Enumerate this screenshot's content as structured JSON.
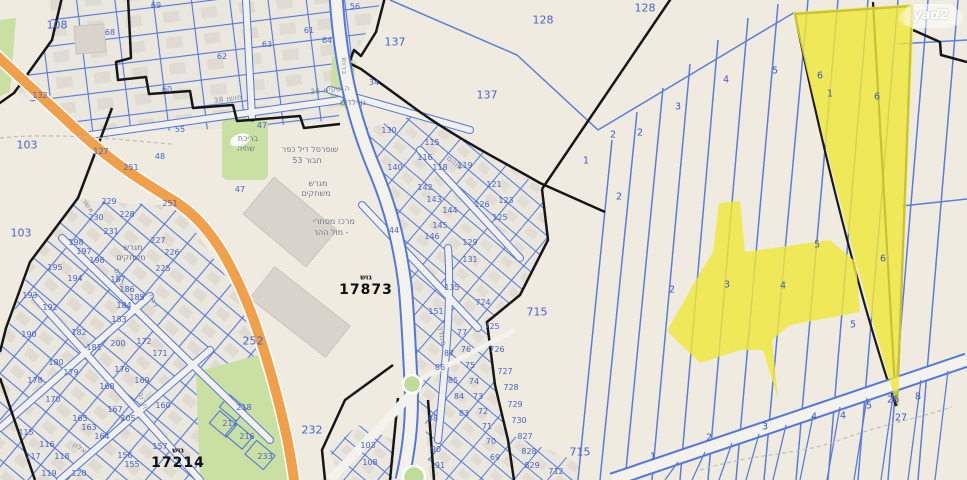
{
  "watermark": {
    "label": "yad2"
  },
  "map": {
    "block_numbers": [
      "17873",
      "17214"
    ],
    "highlight_color": "#EFE73B",
    "parcel_line_color": "#4f72d2",
    "road_color": "#F0A04A",
    "labels": [
      {
        "t": "137",
        "x": 395,
        "y": 42,
        "c": "z"
      },
      {
        "t": "137",
        "x": 487,
        "y": 95,
        "c": "z"
      },
      {
        "t": "128",
        "x": 543,
        "y": 20,
        "c": "z"
      },
      {
        "t": "128",
        "x": 645,
        "y": 8,
        "c": "z"
      },
      {
        "t": "103",
        "x": 27,
        "y": 145,
        "c": "z"
      },
      {
        "t": "103",
        "x": 21,
        "y": 233,
        "c": "z"
      },
      {
        "t": "108",
        "x": 57,
        "y": 25,
        "c": "z"
      },
      {
        "t": "715",
        "x": 537,
        "y": 312,
        "c": "z"
      },
      {
        "t": "715",
        "x": 580,
        "y": 452,
        "c": "z"
      },
      {
        "t": "232",
        "x": 312,
        "y": 430,
        "c": "z"
      },
      {
        "t": "252",
        "x": 253,
        "y": 341,
        "c": "z"
      },
      {
        "t": "68",
        "x": 110,
        "y": 33,
        "c": "n"
      },
      {
        "t": "69",
        "x": 156,
        "y": 6,
        "c": "n"
      },
      {
        "t": "60",
        "x": 167,
        "y": 90,
        "c": "n"
      },
      {
        "t": "62",
        "x": 222,
        "y": 57,
        "c": "n"
      },
      {
        "t": "63",
        "x": 267,
        "y": 45,
        "c": "n"
      },
      {
        "t": "61",
        "x": 309,
        "y": 31,
        "c": "n"
      },
      {
        "t": "64",
        "x": 327,
        "y": 41,
        "c": "n"
      },
      {
        "t": "56",
        "x": 355,
        "y": 7,
        "c": "n"
      },
      {
        "t": "55",
        "x": 180,
        "y": 130,
        "c": "n"
      },
      {
        "t": "48",
        "x": 160,
        "y": 157,
        "c": "n"
      },
      {
        "t": "127",
        "x": 101,
        "y": 152,
        "c": "n"
      },
      {
        "t": "132",
        "x": 40,
        "y": 96,
        "c": "n"
      },
      {
        "t": "47",
        "x": 262,
        "y": 126,
        "c": "n"
      },
      {
        "t": "47",
        "x": 240,
        "y": 190,
        "c": "n"
      },
      {
        "t": "34",
        "x": 374,
        "y": 83,
        "c": "n"
      },
      {
        "t": "251",
        "x": 131,
        "y": 168,
        "c": "n"
      },
      {
        "t": "251",
        "x": 170,
        "y": 204,
        "c": "n"
      },
      {
        "t": "229",
        "x": 109,
        "y": 202,
        "c": "n"
      },
      {
        "t": "230",
        "x": 96,
        "y": 218,
        "c": "n"
      },
      {
        "t": "228",
        "x": 127,
        "y": 215,
        "c": "n"
      },
      {
        "t": "231",
        "x": 111,
        "y": 232,
        "c": "n"
      },
      {
        "t": "227",
        "x": 158,
        "y": 241,
        "c": "n"
      },
      {
        "t": "226",
        "x": 172,
        "y": 253,
        "c": "n"
      },
      {
        "t": "225",
        "x": 163,
        "y": 269,
        "c": "n"
      },
      {
        "t": "198",
        "x": 76,
        "y": 243,
        "c": "n"
      },
      {
        "t": "197",
        "x": 84,
        "y": 252,
        "c": "n"
      },
      {
        "t": "196",
        "x": 97,
        "y": 261,
        "c": "n"
      },
      {
        "t": "195",
        "x": 55,
        "y": 268,
        "c": "n"
      },
      {
        "t": "194",
        "x": 75,
        "y": 279,
        "c": "n"
      },
      {
        "t": "193",
        "x": 30,
        "y": 296,
        "c": "n"
      },
      {
        "t": "192",
        "x": 50,
        "y": 308,
        "c": "n"
      },
      {
        "t": "187",
        "x": 118,
        "y": 280,
        "c": "n"
      },
      {
        "t": "186",
        "x": 127,
        "y": 290,
        "c": "n"
      },
      {
        "t": "185",
        "x": 137,
        "y": 298,
        "c": "n"
      },
      {
        "t": "184",
        "x": 124,
        "y": 306,
        "c": "n"
      },
      {
        "t": "183",
        "x": 119,
        "y": 320,
        "c": "n"
      },
      {
        "t": "182",
        "x": 79,
        "y": 333,
        "c": "n"
      },
      {
        "t": "181",
        "x": 94,
        "y": 348,
        "c": "n"
      },
      {
        "t": "200",
        "x": 118,
        "y": 344,
        "c": "n"
      },
      {
        "t": "190",
        "x": 29,
        "y": 335,
        "c": "n"
      },
      {
        "t": "180",
        "x": 56,
        "y": 363,
        "c": "n"
      },
      {
        "t": "179",
        "x": 71,
        "y": 373,
        "c": "n"
      },
      {
        "t": "178",
        "x": 35,
        "y": 381,
        "c": "n"
      },
      {
        "t": "176",
        "x": 122,
        "y": 370,
        "c": "n"
      },
      {
        "t": "172",
        "x": 144,
        "y": 342,
        "c": "n"
      },
      {
        "t": "171",
        "x": 160,
        "y": 354,
        "c": "n"
      },
      {
        "t": "169",
        "x": 142,
        "y": 381,
        "c": "n"
      },
      {
        "t": "168",
        "x": 107,
        "y": 387,
        "c": "n"
      },
      {
        "t": "170",
        "x": 53,
        "y": 400,
        "c": "n"
      },
      {
        "t": "167",
        "x": 115,
        "y": 410,
        "c": "n"
      },
      {
        "t": "205",
        "x": 128,
        "y": 419,
        "c": "n"
      },
      {
        "t": "160",
        "x": 163,
        "y": 406,
        "c": "n"
      },
      {
        "t": "165",
        "x": 80,
        "y": 419,
        "c": "n"
      },
      {
        "t": "163",
        "x": 89,
        "y": 428,
        "c": "n"
      },
      {
        "t": "164",
        "x": 102,
        "y": 437,
        "c": "n"
      },
      {
        "t": "115",
        "x": 26,
        "y": 433,
        "c": "n"
      },
      {
        "t": "116",
        "x": 47,
        "y": 445,
        "c": "n"
      },
      {
        "t": "117",
        "x": 33,
        "y": 457,
        "c": "n"
      },
      {
        "t": "118",
        "x": 62,
        "y": 457,
        "c": "n"
      },
      {
        "t": "119",
        "x": 49,
        "y": 474,
        "c": "n"
      },
      {
        "t": "120",
        "x": 79,
        "y": 474,
        "c": "n"
      },
      {
        "t": "157",
        "x": 160,
        "y": 447,
        "c": "n"
      },
      {
        "t": "156",
        "x": 125,
        "y": 456,
        "c": "n"
      },
      {
        "t": "155",
        "x": 132,
        "y": 465,
        "c": "n"
      },
      {
        "t": "130",
        "x": 389,
        "y": 131,
        "c": "n"
      },
      {
        "t": "115",
        "x": 432,
        "y": 143,
        "c": "n"
      },
      {
        "t": "116",
        "x": 425,
        "y": 158,
        "c": "n"
      },
      {
        "t": "118",
        "x": 440,
        "y": 168,
        "c": "n"
      },
      {
        "t": "119",
        "x": 465,
        "y": 166,
        "c": "n"
      },
      {
        "t": "140",
        "x": 395,
        "y": 168,
        "c": "n"
      },
      {
        "t": "121",
        "x": 494,
        "y": 185,
        "c": "n"
      },
      {
        "t": "126",
        "x": 482,
        "y": 205,
        "c": "n"
      },
      {
        "t": "123",
        "x": 506,
        "y": 201,
        "c": "n"
      },
      {
        "t": "125",
        "x": 500,
        "y": 218,
        "c": "n"
      },
      {
        "t": "142",
        "x": 425,
        "y": 188,
        "c": "n"
      },
      {
        "t": "143",
        "x": 434,
        "y": 200,
        "c": "n"
      },
      {
        "t": "144",
        "x": 450,
        "y": 211,
        "c": "n"
      },
      {
        "t": "145",
        "x": 440,
        "y": 226,
        "c": "n"
      },
      {
        "t": "146",
        "x": 432,
        "y": 237,
        "c": "n"
      },
      {
        "t": "129",
        "x": 470,
        "y": 243,
        "c": "n"
      },
      {
        "t": "131",
        "x": 470,
        "y": 260,
        "c": "n"
      },
      {
        "t": "44",
        "x": 394,
        "y": 231,
        "c": "n"
      },
      {
        "t": "216",
        "x": 247,
        "y": 437,
        "c": "n"
      },
      {
        "t": "217",
        "x": 230,
        "y": 424,
        "c": "n"
      },
      {
        "t": "218",
        "x": 244,
        "y": 408,
        "c": "n"
      },
      {
        "t": "233",
        "x": 265,
        "y": 457,
        "c": "n"
      },
      {
        "t": "135",
        "x": 452,
        "y": 288,
        "c": "n"
      },
      {
        "t": "151",
        "x": 436,
        "y": 312,
        "c": "n"
      },
      {
        "t": "724",
        "x": 483,
        "y": 303,
        "c": "n"
      },
      {
        "t": "725",
        "x": 492,
        "y": 327,
        "c": "n"
      },
      {
        "t": "726",
        "x": 497,
        "y": 350,
        "c": "n"
      },
      {
        "t": "727",
        "x": 505,
        "y": 372,
        "c": "n"
      },
      {
        "t": "728",
        "x": 511,
        "y": 388,
        "c": "n"
      },
      {
        "t": "729",
        "x": 515,
        "y": 405,
        "c": "n"
      },
      {
        "t": "730",
        "x": 519,
        "y": 421,
        "c": "n"
      },
      {
        "t": "827",
        "x": 525,
        "y": 437,
        "c": "n"
      },
      {
        "t": "828",
        "x": 529,
        "y": 452,
        "c": "n"
      },
      {
        "t": "829",
        "x": 532,
        "y": 466,
        "c": "n"
      },
      {
        "t": "712",
        "x": 556,
        "y": 472,
        "c": "n"
      },
      {
        "t": "77",
        "x": 462,
        "y": 333,
        "c": "n"
      },
      {
        "t": "76",
        "x": 466,
        "y": 350,
        "c": "n"
      },
      {
        "t": "75",
        "x": 470,
        "y": 366,
        "c": "n"
      },
      {
        "t": "74",
        "x": 474,
        "y": 382,
        "c": "n"
      },
      {
        "t": "73",
        "x": 478,
        "y": 397,
        "c": "n"
      },
      {
        "t": "72",
        "x": 483,
        "y": 412,
        "c": "n"
      },
      {
        "t": "71",
        "x": 487,
        "y": 427,
        "c": "n"
      },
      {
        "t": "70",
        "x": 491,
        "y": 442,
        "c": "n"
      },
      {
        "t": "69",
        "x": 495,
        "y": 458,
        "c": "n"
      },
      {
        "t": "87",
        "x": 449,
        "y": 354,
        "c": "n"
      },
      {
        "t": "86",
        "x": 440,
        "y": 368,
        "c": "n"
      },
      {
        "t": "85",
        "x": 453,
        "y": 381,
        "c": "n"
      },
      {
        "t": "84",
        "x": 459,
        "y": 397,
        "c": "n"
      },
      {
        "t": "83",
        "x": 464,
        "y": 414,
        "c": "n"
      },
      {
        "t": "88",
        "x": 433,
        "y": 419,
        "c": "n"
      },
      {
        "t": "90",
        "x": 436,
        "y": 450,
        "c": "n"
      },
      {
        "t": "91",
        "x": 440,
        "y": 466,
        "c": "n"
      },
      {
        "t": "103",
        "x": 368,
        "y": 446,
        "c": "n"
      },
      {
        "t": "108",
        "x": 370,
        "y": 463,
        "c": "n"
      },
      {
        "t": "1",
        "x": 586,
        "y": 161,
        "c": "m"
      },
      {
        "t": "2",
        "x": 613,
        "y": 135,
        "c": "m"
      },
      {
        "t": "2",
        "x": 640,
        "y": 133,
        "c": "m"
      },
      {
        "t": "3",
        "x": 678,
        "y": 107,
        "c": "m"
      },
      {
        "t": "2",
        "x": 619,
        "y": 197,
        "c": "m"
      },
      {
        "t": "5",
        "x": 775,
        "y": 71,
        "c": "m"
      },
      {
        "t": "4",
        "x": 726,
        "y": 80,
        "c": "m"
      },
      {
        "t": "2",
        "x": 672,
        "y": 290,
        "c": "m"
      },
      {
        "t": "3",
        "x": 727,
        "y": 285,
        "c": "m"
      },
      {
        "t": "4",
        "x": 783,
        "y": 286,
        "c": "m"
      },
      {
        "t": "5",
        "x": 817,
        "y": 245,
        "c": "m"
      },
      {
        "t": "6",
        "x": 883,
        "y": 259,
        "c": "m"
      },
      {
        "t": "6",
        "x": 820,
        "y": 76,
        "c": "m"
      },
      {
        "t": "1",
        "x": 830,
        "y": 94,
        "c": "m"
      },
      {
        "t": "6",
        "x": 877,
        "y": 97,
        "c": "m"
      },
      {
        "t": "5",
        "x": 853,
        "y": 325,
        "c": "m"
      },
      {
        "t": "1",
        "x": 653,
        "y": 457,
        "c": "m"
      },
      {
        "t": "2",
        "x": 709,
        "y": 438,
        "c": "m"
      },
      {
        "t": "3",
        "x": 765,
        "y": 427,
        "c": "m"
      },
      {
        "t": "4",
        "x": 814,
        "y": 417,
        "c": "m"
      },
      {
        "t": "4",
        "x": 843,
        "y": 416,
        "c": "m"
      },
      {
        "t": "5",
        "x": 869,
        "y": 406,
        "c": "m"
      },
      {
        "t": "27",
        "x": 901,
        "y": 418,
        "c": "m"
      },
      {
        "t": "26",
        "x": 893,
        "y": 400,
        "c": "m"
      },
      {
        "t": "8",
        "x": 918,
        "y": 397,
        "c": "m"
      },
      {
        "t": "ברוש",
        "x": 344,
        "y": 66,
        "c": "st",
        "r": 90
      },
      {
        "t": "חושן 38",
        "x": 228,
        "y": 99,
        "c": "st",
        "r": -8
      },
      {
        "t": "הנטעים 36",
        "x": 330,
        "y": 90,
        "c": "st",
        "r": -6
      },
      {
        "t": "שוהם",
        "x": 455,
        "y": 163,
        "c": "st",
        "r": 38
      },
      {
        "t": "סמדר",
        "x": 442,
        "y": 336,
        "c": "st",
        "r": 78
      },
      {
        "t": "אשר",
        "x": 88,
        "y": 206,
        "c": "st",
        "r": 55
      },
      {
        "t": "רותם",
        "x": 119,
        "y": 277,
        "c": "st",
        "r": 72
      },
      {
        "t": "דרור",
        "x": 153,
        "y": 300,
        "c": "st",
        "r": 70
      },
      {
        "t": "אלון",
        "x": 80,
        "y": 448,
        "c": "st",
        "r": 35
      },
      {
        "t": "חרוב",
        "x": 143,
        "y": 401,
        "c": "st",
        "r": 72
      },
      {
        "t": "בריכת",
        "x": 248,
        "y": 139,
        "c": "pl"
      },
      {
        "t": "שחיה",
        "x": 246,
        "y": 149,
        "c": "pl"
      },
      {
        "t": "שופרסל דיל כפר",
        "x": 310,
        "y": 150,
        "c": "pl"
      },
      {
        "t": "תבור 53",
        "x": 307,
        "y": 161,
        "c": "pl"
      },
      {
        "t": "גן ילדים",
        "x": 353,
        "y": 103,
        "c": "pl"
      },
      {
        "t": "מגרש",
        "x": 318,
        "y": 184,
        "c": "pl"
      },
      {
        "t": "משחקים",
        "x": 316,
        "y": 194,
        "c": "pl"
      },
      {
        "t": "מגרש",
        "x": 133,
        "y": 248,
        "c": "pl"
      },
      {
        "t": "משחקים",
        "x": 131,
        "y": 258,
        "c": "pl"
      },
      {
        "t": "מרכז מסחרי",
        "x": 334,
        "y": 222,
        "c": "pl"
      },
      {
        "t": "- מול ההר",
        "x": 331,
        "y": 233,
        "c": "pl"
      },
      {
        "t": "גוש",
        "x": 366,
        "y": 277,
        "c": "g"
      },
      {
        "t": "17873",
        "x": 366,
        "y": 290,
        "c": "G"
      },
      {
        "t": "גוש",
        "x": 178,
        "y": 450,
        "c": "g"
      },
      {
        "t": "17214",
        "x": 178,
        "y": 463,
        "c": "G"
      }
    ]
  }
}
